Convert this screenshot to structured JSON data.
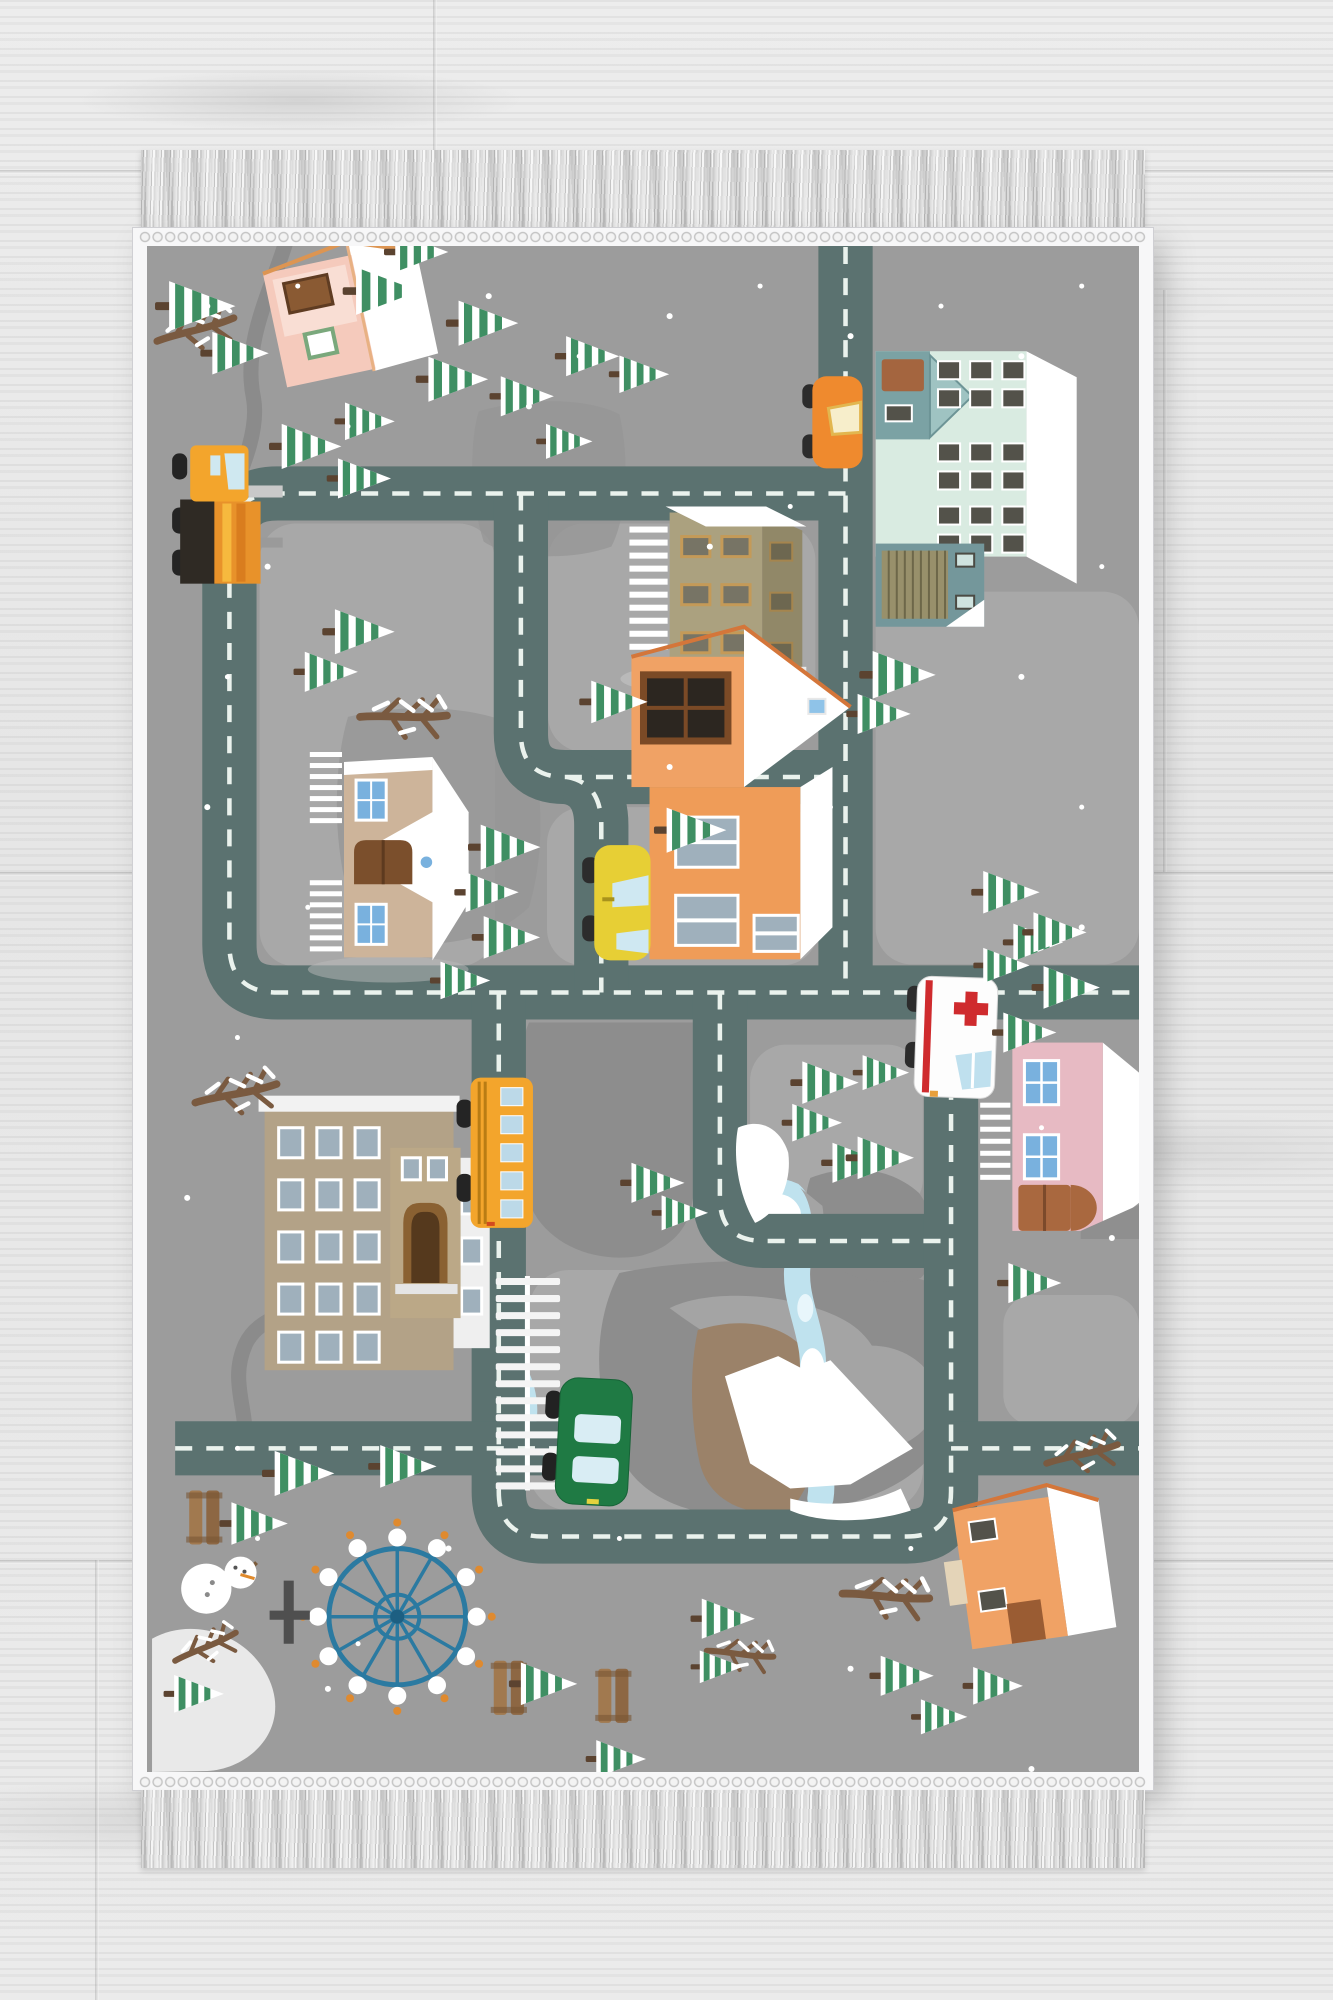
{
  "scene": {
    "type": "product-photograph",
    "subject": "Children's winter-town road-map play rug photographed from above on a light gray wooden floor",
    "floor": "light gray wood planks with visible grain and seams",
    "rug": {
      "orientation": "vertical rectangle",
      "edge": "white woven selvedge border",
      "fringe": "gray-white knotted tassel fringe on top and bottom ends",
      "theme": "winter city play mat with roads, houses, vehicles, pine trees, mountains, river and park"
    },
    "buildings": [
      "pink cottage top-left",
      "mint apartment block with garage top-right",
      "tan office building top-center",
      "tan church with blue windows left-center",
      "orange two-story house center",
      "pink house with blue windows right",
      "large tan school with arched entrance left",
      "orange cottage bottom-right"
    ],
    "vehicles": [
      "orange car on top road",
      "orange crane truck on left road",
      "yellow taxi on center road",
      "white ambulance with red cross on right road",
      "yellow school bus on left-center road",
      "green car at railroad crossing"
    ],
    "park_items": [
      "blue ferris wheel with white gondolas",
      "snowman",
      "wooden benches",
      "snow mound",
      "dark signpost tree"
    ],
    "nature": [
      "snowy pine trees lying toward the right",
      "bare snowy branches",
      "gray mountains with white snow caps",
      "light blue lake, river and pond",
      "scattered snow dots"
    ],
    "counts": {
      "trees": 48,
      "vehicles": 6,
      "buildings": 8,
      "benches": 3,
      "branches": 7
    }
  },
  "palette": {
    "rugBase": "#9c9c9c",
    "block": "#a8a8a8",
    "road": "#5b7270",
    "dash": "#eaf2ed",
    "pathGray": "#8b8b8b",
    "treeGreen": "#3f8f63",
    "trunk": "#5b4330",
    "water": "#bfe2ee",
    "mountainDark": "#8d8d8d",
    "mountainMid": "#a4a4a4",
    "mountainLight": "#bdbdbd",
    "mint": "#d9ebe1",
    "tanWall": "#aba17f",
    "church": "#cdb49a",
    "school": "#b3a287",
    "orangeHouse": "#f0a265",
    "pinkHouse": "#e7bac3",
    "pinkCottage": "#f5cabc",
    "taxi": "#e7cf35",
    "bus": "#f3a52c",
    "orangeCar": "#ef8a2e",
    "greenCar": "#1f7a44",
    "ambulanceRed": "#cf2b2e",
    "ferris": "#2b7aa1",
    "bench": "#a1794f",
    "brownPatch": "#9b8269"
  }
}
